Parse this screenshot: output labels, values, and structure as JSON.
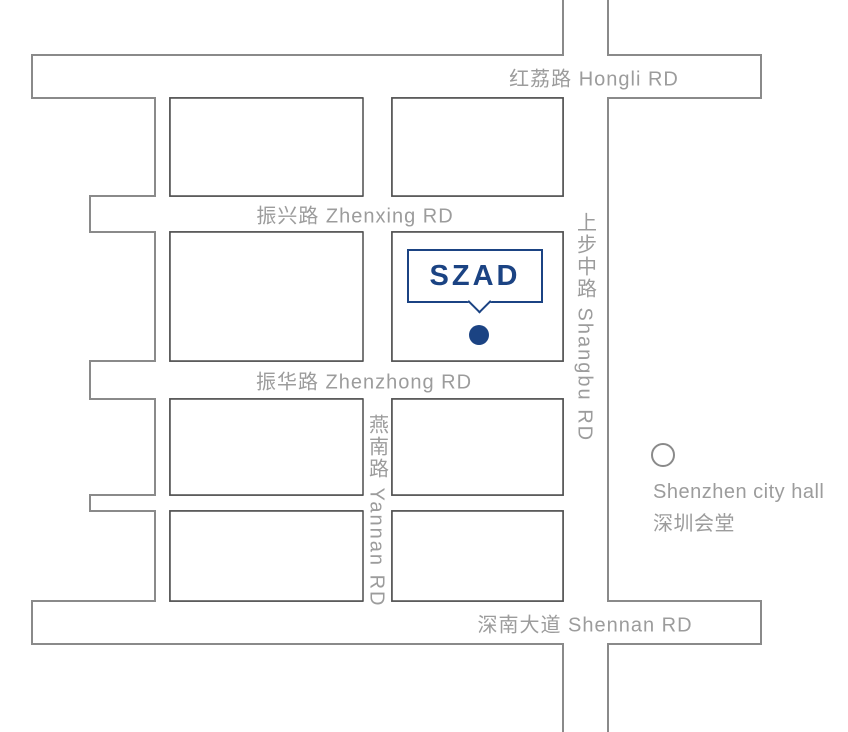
{
  "map": {
    "roads": {
      "hongli": {
        "label": "红荔路 Hongli RD"
      },
      "zhenxing": {
        "label": "振兴路 Zhenxing RD"
      },
      "zhenzhong": {
        "label": "振华路 Zhenzhong RD"
      },
      "shennan": {
        "label": "深南大道 Shennan RD"
      },
      "shangbu": {
        "label": "上步中路 Shangbu RD"
      },
      "yannan": {
        "label": "燕南路 Yannan RD"
      }
    },
    "marker": {
      "label": "SZAD"
    },
    "poi": {
      "line1": "Shenzhen city hall",
      "line2": "深圳会堂"
    },
    "colors": {
      "accent": "#1b4383",
      "road_outline": "#8a8a8a",
      "block_outline": "#4d4d4d",
      "label_text": "#9c9c9c"
    }
  }
}
